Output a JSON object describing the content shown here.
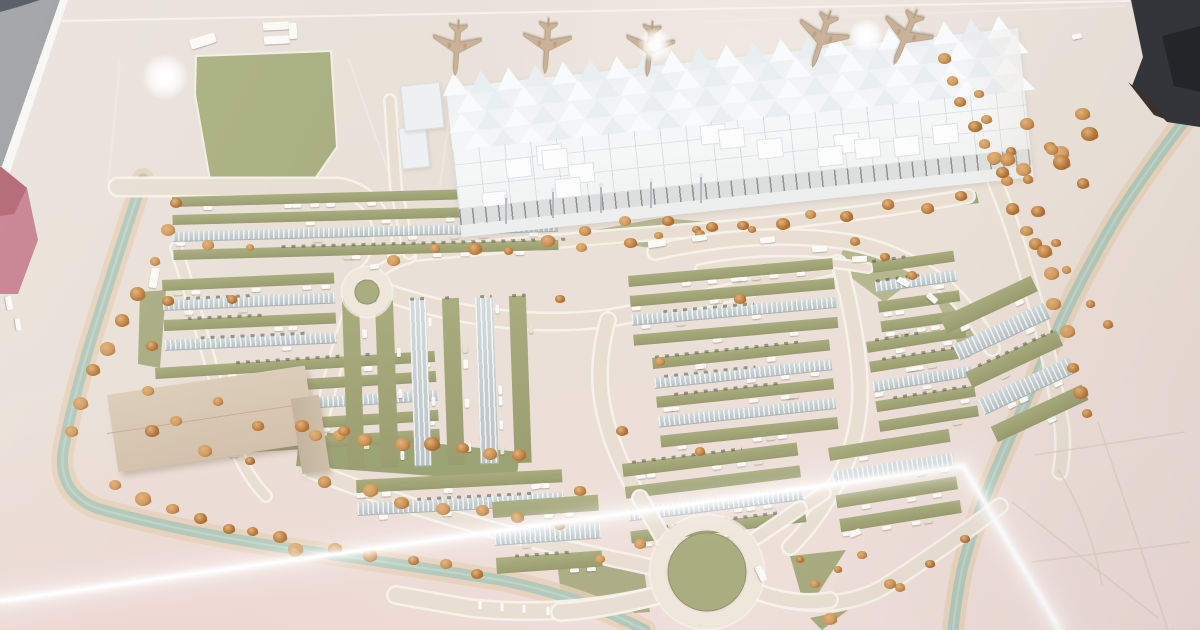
{
  "meta": {
    "description": "Photograph taken through glass of a physical architectural scale model: an airport terminal with spiky white canopy roof, five tan model airplanes on the apron, large landscaped parking lots with autumn trees, roundabouts, a tan logistics building, and teal water channels; bright tube-light reflections streak across the glass.",
    "visible_text": []
  },
  "palette": {
    "ground": "#e9e2d9",
    "road": "#e8dfd2",
    "road_edge": "#f7f2ea",
    "olive": "#a9ad80",
    "olive_dark": "#989c6e",
    "canopy": "#c6d0d1",
    "water": "#b2c8ba",
    "bank": "#e6d0b6",
    "terminal": "#f4f6f6",
    "terminal_shade": "#e6ebec",
    "tree": "#c88f52",
    "tree_dark": "#8a5527",
    "plane": "#c9b297",
    "building": "#d8c9b5",
    "gray_edge": "#9b9fa0",
    "pink_edge": "#c5808c",
    "dark_object": "#33363a",
    "streak": "#ffffff"
  },
  "scene": {
    "apron": {
      "lines": [
        [
          348,
          58,
          392,
          182
        ],
        [
          120,
          62,
          108,
          184
        ],
        [
          700,
          22,
          1125,
          6
        ],
        [
          452,
          96,
          440,
          186
        ]
      ]
    },
    "field": {
      "points": "196,56 331,51 337,147 312,183 211,186 195,94",
      "color": "#a9b080"
    },
    "greens": [
      {
        "points": "392,247 700,226 976,192 979,203 700,238 396,261",
        "fill": "#9ba173",
        "op": 0.95
      },
      {
        "points": "563,236 660,218 772,227 688,253",
        "fill": "#afb286",
        "op": 0.9
      },
      {
        "points": "846,236 936,263 884,302 838,268",
        "fill": "#afb286",
        "op": 0.9
      },
      {
        "points": "790,556 846,550 806,612",
        "fill": "#a7ab7e",
        "op": 1
      },
      {
        "points": "810,618 848,610 822,630",
        "fill": "#a7ab7e",
        "op": 1
      },
      {
        "points": "140,292 166,290 160,368 138,364",
        "fill": "#a2a779",
        "op": 0.9
      },
      {
        "points": "300,430 520,452 516,482 296,466",
        "fill": "#98a070",
        "op": 0.95
      },
      {
        "points": "557,562 642,556 650,612 564,618",
        "fill": "#a5a97c",
        "op": 0.9
      },
      {
        "points": "952,292 992,346 962,352 936,300",
        "fill": "#aaae81",
        "op": 0.8
      }
    ],
    "channels": [
      {
        "d": "M143,179 Q115,262 88,350 Q70,412 63,452 Q58,492 96,508 Q180,532 300,550 Q420,567 500,580 Q560,592 612,614 L645,630"
      },
      {
        "d": "M1193,110 Q1152,162 1118,215 Q1078,282 1048,350 Q1020,415 998,465 Q975,518 962,570 Q956,600 953,630"
      }
    ],
    "roads": [
      {
        "d": "M118,187 L338,187 Q372,192 382,226 Q386,258 367,274",
        "w": 16
      },
      {
        "d": "M385,292 Q500,332 610,318 Q720,298 838,264",
        "w": 15
      },
      {
        "d": "M395,256 Q560,240 700,230 Q850,217 968,196",
        "w": 11
      },
      {
        "d": "M373,277 Q388,263 410,257",
        "w": 9
      },
      {
        "d": "M352,308 Q335,360 326,400 L316,444",
        "w": 12
      },
      {
        "d": "M608,320 Q596,362 602,402 Q611,452 640,498 Q656,526 668,546",
        "w": 13
      },
      {
        "d": "M840,266 Q858,332 860,386 Q861,436 838,480 Q816,522 790,547",
        "w": 13
      },
      {
        "d": "M310,470 Q420,512 540,542 Q600,556 652,567",
        "w": 13
      },
      {
        "d": "M655,596 Q560,618 470,608 L396,595",
        "w": 15
      },
      {
        "d": "M760,593 Q830,616 882,588 Q940,551 1000,506",
        "w": 13
      },
      {
        "d": "M756,538 Q790,516 824,493",
        "w": 11
      },
      {
        "d": "M655,252 Q760,228 850,242 Q906,253 946,287 Q976,316 992,348",
        "w": 13
      },
      {
        "d": "M700,269 Q780,253 868,268",
        "w": 7
      },
      {
        "d": "M936,58 Q980,140 1008,215 Q1032,285 1046,345 Q1056,390 1062,428 Q1064,450 1060,472",
        "w": 12
      },
      {
        "d": "M390,100 L396,188 L409,253",
        "w": 9
      },
      {
        "d": "M176,248 Q202,330 226,420 Q240,470 266,496",
        "w": 9
      }
    ],
    "stubs": [
      {
        "d": "M640,498 Q656,526 668,546",
        "w": 13
      },
      {
        "d": "M655,596 Q600,610 560,612",
        "w": 15
      },
      {
        "d": "M760,593 Q800,606 830,600",
        "w": 13
      },
      {
        "d": "M756,538 Q780,522 800,508",
        "w": 11
      }
    ],
    "roundabouts": [
      {
        "cx": 367,
        "cy": 292,
        "ring": 19,
        "rw": 11,
        "center": 12
      },
      {
        "cx": 707,
        "cy": 572,
        "ring": 49,
        "rw": 15,
        "center": 39
      }
    ],
    "lane_dashes": [
      [
        480,
        601,
        480,
        609
      ],
      [
        502,
        603,
        502,
        611
      ],
      [
        524,
        605,
        524,
        613
      ],
      [
        548,
        607,
        548,
        615
      ],
      [
        572,
        608,
        572,
        616
      ],
      [
        596,
        607,
        596,
        615
      ],
      [
        430,
        318,
        430,
        326
      ],
      [
        450,
        322,
        450,
        330
      ]
    ],
    "sketch_lines": [
      "M1035,455 L1185,432",
      "M1012,502 L1158,618",
      "M1098,422 L1168,630",
      "M1032,562 L1190,542",
      "M1058,470 Q1090,520 1102,585"
    ],
    "edges": {
      "gray": "0,0 60,0 2,166 0,166",
      "navy": "0,0 40,0 18,7 0,12",
      "white_band": "60,0 68,0 10,172 0,172 0,166 2,166",
      "pink": "0,166 27,188 38,240 18,294 0,294",
      "pink_dark": "0,166 27,188 14,214 0,216",
      "dark_corner": [
        "1131,0 1200,0 1200,127 1167,122 1132,86 1143,57",
        "1128,82 1154,115 1170,121 1142,93",
        "1162,36 1200,26 1200,92 1174,86"
      ],
      "top_edge": [
        62,
        21,
        1130,
        1
      ]
    },
    "parking_blocks": [
      {
        "x": 172,
        "y": 197,
        "w": 385,
        "h": 70,
        "rot": -1.5,
        "o": "h",
        "rows": 4,
        "canopy": [
          2
        ],
        "cars": 22,
        "seed": 11
      },
      {
        "x": 162,
        "y": 280,
        "w": 172,
        "h": 80,
        "rot": -2.5,
        "o": "h",
        "rows": 4,
        "canopy": [
          1,
          3
        ],
        "cars": 10,
        "seed": 7
      },
      {
        "x": 155,
        "y": 368,
        "w": 280,
        "h": 98,
        "rot": -3.5,
        "o": "h",
        "rows": 5,
        "canopy": [
          2
        ],
        "cars": 16,
        "seed": 13
      },
      {
        "x": 342,
        "y": 302,
        "w": 200,
        "h": 166,
        "rot": -2,
        "o": "v",
        "rows": 6,
        "canopy": [
          2,
          4
        ],
        "cars": 16,
        "seed": 17
      },
      {
        "x": 356,
        "y": 480,
        "w": 206,
        "h": 46,
        "rot": -3,
        "o": "h",
        "rows": 2,
        "canopy": [
          1
        ],
        "cars": 8,
        "seed": 19
      },
      {
        "x": 492,
        "y": 502,
        "w": 106,
        "h": 84,
        "rot": -4,
        "o": "h",
        "rows": 3,
        "canopy": [
          1
        ],
        "cars": 6,
        "seed": 41
      },
      {
        "x": 628,
        "y": 276,
        "w": 205,
        "h": 78,
        "rot": -5,
        "o": "h",
        "rows": 4,
        "canopy": [
          2
        ],
        "cars": 16,
        "seed": 23
      },
      {
        "x": 872,
        "y": 262,
        "w": 82,
        "h": 80,
        "rot": -8,
        "o": "h",
        "rows": 4,
        "canopy": [
          1
        ],
        "cars": 8,
        "seed": 43
      },
      {
        "x": 652,
        "y": 358,
        "w": 178,
        "h": 98,
        "rot": -6,
        "o": "h",
        "rows": 5,
        "canopy": [
          1,
          3
        ],
        "cars": 16,
        "seed": 29
      },
      {
        "x": 866,
        "y": 342,
        "w": 100,
        "h": 100,
        "rot": -9,
        "o": "h",
        "rows": 5,
        "canopy": [
          2
        ],
        "cars": 10,
        "seed": 47
      },
      {
        "x": 622,
        "y": 464,
        "w": 176,
        "h": 90,
        "rot": -7,
        "o": "h",
        "rows": 4,
        "canopy": [
          2
        ],
        "cars": 12,
        "seed": 31
      },
      {
        "x": 828,
        "y": 448,
        "w": 122,
        "h": 96,
        "rot": -9,
        "o": "h",
        "rows": 4,
        "canopy": [
          1
        ],
        "cars": 10,
        "seed": 53
      },
      {
        "x": 940,
        "y": 318,
        "w": 100,
        "h": 150,
        "rot": -25,
        "o": "h",
        "rows": 5,
        "canopy": [
          1,
          3
        ],
        "cars": 8,
        "seed": 37
      }
    ],
    "terminal": {
      "x": 446,
      "y": 88,
      "w": 575,
      "h": 150,
      "rot": -6,
      "spike_rows": [
        {
          "y": -14,
          "h": 22,
          "tw": 26,
          "n": 21,
          "off": -4
        },
        {
          "y": 6,
          "h": 20,
          "tw": 26,
          "n": 21,
          "off": 9
        },
        {
          "y": 27,
          "h": 18,
          "tw": 26,
          "n": 21,
          "off": -1
        },
        {
          "y": 47,
          "h": 16,
          "tw": 26,
          "n": 21,
          "off": 12
        }
      ],
      "tiles": 14,
      "annexes": [
        {
          "x": 398,
          "y": 128,
          "w": 26,
          "h": 40
        },
        {
          "x": 400,
          "y": 86,
          "w": 38,
          "h": 44
        }
      ],
      "masts": [
        [
          505,
          196
        ],
        [
          552,
          190
        ],
        [
          600,
          185
        ],
        [
          650,
          180
        ],
        [
          700,
          175
        ]
      ]
    },
    "building": {
      "main": {
        "x": 107,
        "y": 395,
        "w": 200,
        "h": 78,
        "rot": -8.5
      },
      "wing": {
        "x": 291,
        "y": 399,
        "w": 28,
        "h": 76,
        "rot": -8.5
      }
    },
    "planes": [
      {
        "cx": 457,
        "cy": 47,
        "r": 184,
        "s": 0.6
      },
      {
        "cx": 547,
        "cy": 45,
        "r": 184,
        "s": 0.6
      },
      {
        "cx": 650,
        "cy": 48,
        "r": 186,
        "s": 0.6
      },
      {
        "cx": 822,
        "cy": 38,
        "r": 198,
        "s": 0.64
      },
      {
        "cx": 906,
        "cy": 36,
        "r": 203,
        "s": 0.64
      }
    ],
    "plane_path": "M0,-48 C2.6,-44 3.6,-36 3.6,-28 L3.6,-10 L40,12 L40,17 L4.2,8 L4.2,24 L15,34 L15,38 L0,34.5 L-15,38 L-15,34 L-4.2,24 L-4.2,8 L-40,17 L-40,12 L-3.6,-10 L-3.6,-28 C-3.6,-36 -2.6,-44 0,-48 Z",
    "trees": [
      {
        "type": "line",
        "x1": 177,
        "y1": 205,
        "x2": 70,
        "y2": 430,
        "n": 9,
        "s": 13
      },
      {
        "type": "line",
        "x1": 120,
        "y1": 492,
        "x2": 300,
        "y2": 548,
        "n": 8,
        "s": 14
      },
      {
        "type": "line",
        "x1": 300,
        "y1": 548,
        "x2": 480,
        "y2": 572,
        "n": 6,
        "s": 13
      },
      {
        "type": "line",
        "x1": 398,
        "y1": 258,
        "x2": 700,
        "y2": 234,
        "n": 9,
        "s": 12
      },
      {
        "type": "line",
        "x1": 706,
        "y1": 232,
        "x2": 962,
        "y2": 200,
        "n": 8,
        "s": 12
      },
      {
        "type": "line",
        "x1": 940,
        "y1": 62,
        "x2": 1040,
        "y2": 250,
        "n": 10,
        "s": 13
      },
      {
        "type": "line",
        "x1": 1040,
        "y1": 250,
        "x2": 1092,
        "y2": 420,
        "n": 7,
        "s": 13
      },
      {
        "type": "line",
        "x1": 975,
        "y1": 90,
        "x2": 1105,
        "y2": 330,
        "n": 9,
        "s": 12
      },
      {
        "type": "blob",
        "x": 990,
        "y": 100,
        "w": 100,
        "h": 85,
        "n": 12,
        "s": 15
      },
      {
        "type": "line",
        "x1": 330,
        "y1": 486,
        "x2": 560,
        "y2": 528,
        "n": 7,
        "s": 13
      },
      {
        "type": "line",
        "x1": 310,
        "y1": 432,
        "x2": 515,
        "y2": 458,
        "n": 8,
        "s": 13
      },
      {
        "type": "points",
        "pts": [
          [
            600,
            560
          ],
          [
            640,
            545
          ],
          [
            830,
            620
          ],
          [
            862,
            556
          ],
          [
            900,
            588
          ]
        ],
        "s": 12
      },
      {
        "type": "points",
        "pts": [
          [
            168,
            302
          ],
          [
            152,
            347
          ],
          [
            148,
            392
          ],
          [
            176,
            422
          ],
          [
            218,
            402
          ],
          [
            258,
            427
          ],
          [
            302,
            427
          ],
          [
            344,
            432
          ],
          [
            152,
            432
          ],
          [
            232,
            300
          ],
          [
            208,
            246
          ],
          [
            250,
            248
          ]
        ],
        "s": 11
      },
      {
        "type": "points",
        "pts": [
          [
            585,
            232
          ],
          [
            625,
            222
          ],
          [
            668,
            222
          ],
          [
            712,
            228
          ],
          [
            752,
            230
          ],
          [
            855,
            242
          ],
          [
            885,
            258
          ],
          [
            912,
            276
          ]
        ],
        "s": 11
      },
      {
        "type": "points",
        "pts": [
          [
            560,
            300
          ],
          [
            660,
            362
          ],
          [
            622,
            432
          ],
          [
            700,
            452
          ],
          [
            580,
            492
          ],
          [
            740,
            300
          ]
        ],
        "s": 11
      },
      {
        "type": "points",
        "pts": [
          [
            250,
            462
          ],
          [
            205,
            452
          ]
        ],
        "s": 12
      },
      {
        "type": "points",
        "pts": [
          [
            800,
            560
          ],
          [
            815,
            585
          ],
          [
            838,
            570
          ]
        ],
        "s": 10
      },
      {
        "type": "points",
        "pts": [
          [
            890,
            585
          ],
          [
            930,
            565
          ],
          [
            965,
            540
          ]
        ],
        "s": 11
      }
    ],
    "vehicles": [
      {
        "x": 190,
        "y": 36,
        "w": 26,
        "h": 10,
        "r": -18
      },
      {
        "x": 263,
        "y": 22,
        "w": 26,
        "h": 8,
        "r": -3
      },
      {
        "x": 264,
        "y": 36,
        "w": 26,
        "h": 8,
        "r": -3
      },
      {
        "x": 289,
        "y": 23,
        "w": 8,
        "h": 16,
        "r": -3
      },
      {
        "x": 150,
        "y": 268,
        "w": 8,
        "h": 20,
        "r": 10
      },
      {
        "x": 370,
        "y": 264,
        "w": 9,
        "h": 5,
        "r": -6
      },
      {
        "x": 531,
        "y": 484,
        "w": 10,
        "h": 5,
        "r": -12
      },
      {
        "x": 753,
        "y": 570,
        "w": 16,
        "h": 7,
        "r": 64
      },
      {
        "x": 849,
        "y": 530,
        "w": 12,
        "h": 6,
        "r": -22
      },
      {
        "x": 1072,
        "y": 34,
        "w": 10,
        "h": 5,
        "r": -12
      },
      {
        "x": 648,
        "y": 240,
        "w": 18,
        "h": 7,
        "r": -8
      },
      {
        "x": 692,
        "y": 235,
        "w": 15,
        "h": 6,
        "r": -8
      },
      {
        "x": 760,
        "y": 237,
        "w": 15,
        "h": 6,
        "r": -6
      },
      {
        "x": 812,
        "y": 246,
        "w": 15,
        "h": 6,
        "r": -5
      },
      {
        "x": 852,
        "y": 256,
        "w": 15,
        "h": 6,
        "r": -3
      },
      {
        "x": 897,
        "y": 279,
        "w": 13,
        "h": 6,
        "r": 28
      },
      {
        "x": 926,
        "y": 295,
        "w": 12,
        "h": 6,
        "r": 40
      },
      {
        "x": 2,
        "y": 300,
        "w": 14,
        "h": 6,
        "r": 80
      },
      {
        "x": 12,
        "y": 322,
        "w": 12,
        "h": 5,
        "r": 80
      }
    ],
    "streak": {
      "points": "0,601 963,466 1060,630"
    },
    "glares": [
      {
        "x": 165,
        "y": 77,
        "r": 15
      },
      {
        "x": 655,
        "y": 45,
        "r": 11
      },
      {
        "x": 866,
        "y": 36,
        "r": 11
      }
    ]
  }
}
